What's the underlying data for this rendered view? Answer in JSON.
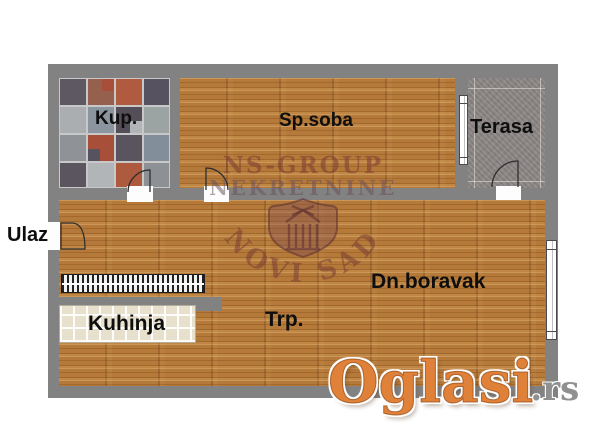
{
  "floorplan": {
    "rooms": [
      {
        "label": "Kup."
      },
      {
        "label": "Sp.soba"
      },
      {
        "label": "Terasa"
      },
      {
        "label": "Ulaz"
      },
      {
        "label": "Kuhinja"
      },
      {
        "label": "Trp."
      },
      {
        "label": "Dn.boravak"
      }
    ],
    "agency_watermark": {
      "line1": "NS-GROUP",
      "line2": "NEKRETNINE",
      "arc_text": "NOVI SAD"
    },
    "site_watermark": {
      "brand": "Oglasi",
      "suffix": ".rs"
    },
    "colors": {
      "wall": "#828282",
      "wood_floor": "#b5793a",
      "bathroom_tile_accent": "#b05a40",
      "terrace_floor": "#8e8a88",
      "kitchen_floor": "#e7e0cc",
      "label_text": "#0e0e0e",
      "agency_watermark_tint": "#7a3a32",
      "site_watermark_orange": "#e0813a",
      "site_watermark_gray": "#909090"
    }
  }
}
